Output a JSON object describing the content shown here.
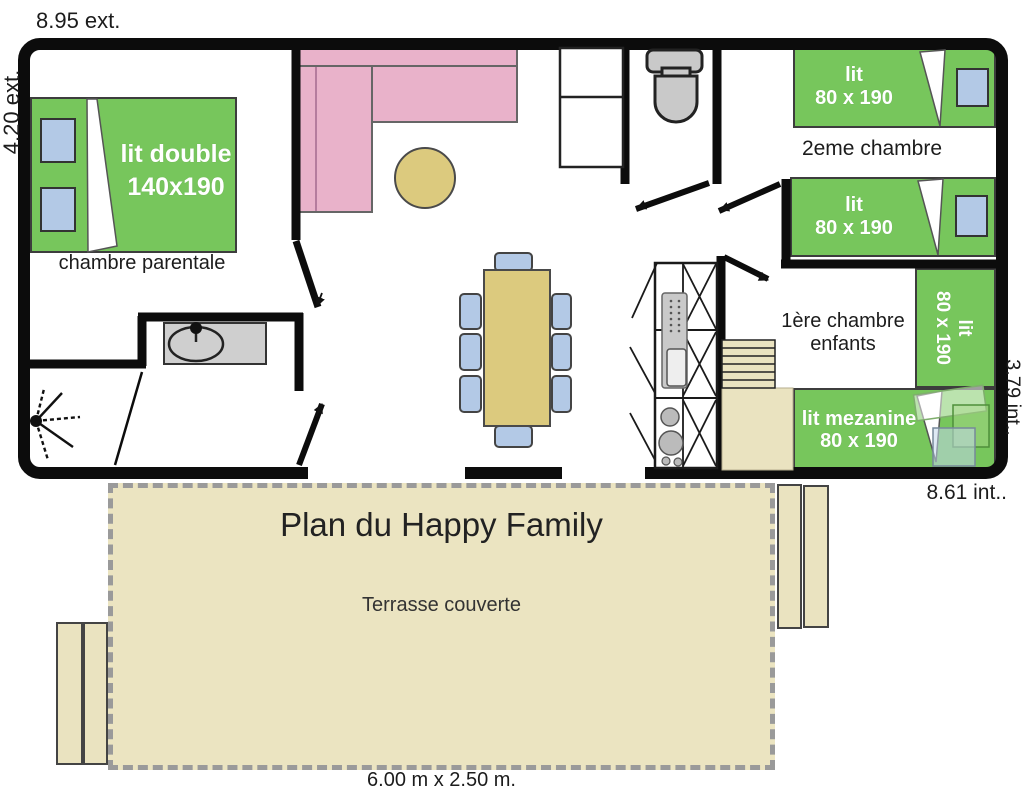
{
  "title": "Plan du Happy Family",
  "dimensions": {
    "top_exterior": "8.95 ext.",
    "left_exterior": "4.20 ext.",
    "right_interior": "3.79 int..",
    "bottom_interior": "8.61 int..",
    "terrace_size": "6.00 m x 2.50 m."
  },
  "rooms": {
    "parental": {
      "name": "chambre parentale",
      "bed": {
        "line1": "lit double",
        "line2": "140x190"
      }
    },
    "second_bedroom": {
      "name": "2eme chambre",
      "bed_top": {
        "line1": "lit",
        "line2": "80 x 190"
      },
      "bed_bottom": {
        "line1": "lit",
        "line2": "80 x 190"
      }
    },
    "first_bedroom": {
      "name_line1": "1ère chambre",
      "name_line2": "enfants",
      "bed_vertical": {
        "line1": "lit",
        "line2": "80 x 190"
      },
      "bed_mezzanine": {
        "line1": "lit mezanine",
        "line2": "80 x 190"
      }
    },
    "terrace": {
      "name": "Terrasse couverte"
    }
  },
  "colors": {
    "bed_green": "#77c65c",
    "pillow_blue": "#b3c9e6",
    "sofa_pink": "#e9b2ca",
    "wood_tan": "#dcca7e",
    "light_tan": "#eae3c0",
    "terrace_tan": "#ebe4c1",
    "fixture_gray": "#c9c9c9",
    "wall_black": "#0c0c0c",
    "dash_gray": "#9a9a9a",
    "sofa_divider": "#a86f92"
  }
}
